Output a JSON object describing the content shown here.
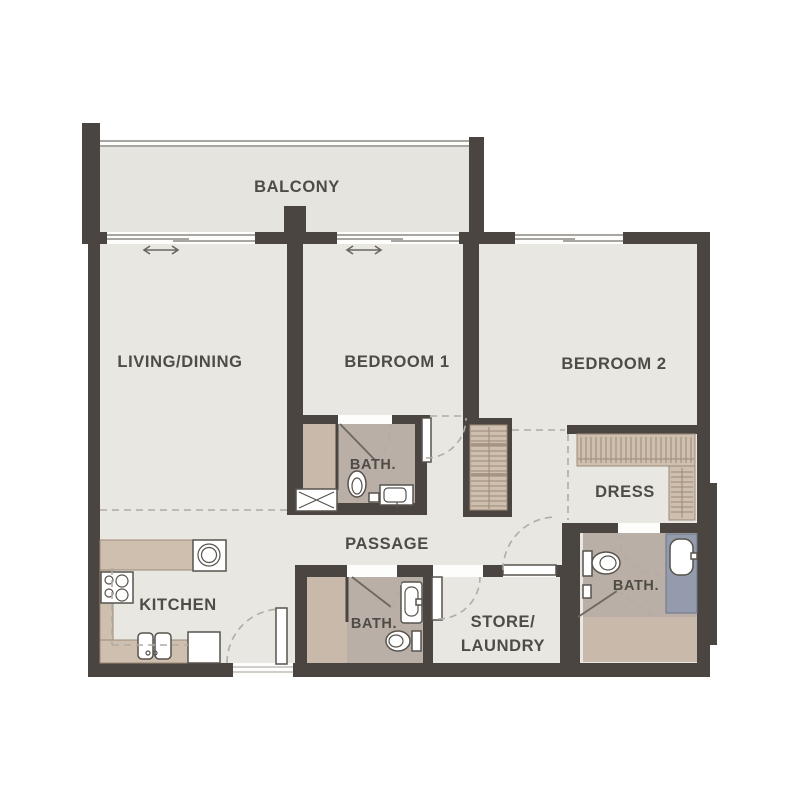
{
  "plan": {
    "type": "2-bedroom apartment floor plan",
    "rooms": {
      "balcony": {
        "label": "BALCONY"
      },
      "living_dining": {
        "label": "LIVING/DINING"
      },
      "bedroom_1": {
        "label": "BEDROOM 1"
      },
      "bedroom_2": {
        "label": "BEDROOM 2"
      },
      "bath_1": {
        "label": "BATH."
      },
      "passage": {
        "label": "PASSAGE"
      },
      "dress": {
        "label": "DRESS"
      },
      "kitchen": {
        "label": "KITCHEN"
      },
      "bath_2": {
        "label": "BATH."
      },
      "store_laundry": {
        "line1": "STORE/",
        "line2": "LAUNDRY"
      },
      "bath_3": {
        "label": "BATH."
      }
    },
    "colors": {
      "wall": "#4a4540",
      "floor": "#e9e7e2",
      "balcony_floor": "#e6e4df",
      "bath_floor": "#b9afa7",
      "wet_floor": "#c9b9ab",
      "cabinet": "#cfbfaf",
      "cabinet_line": "#9b8a79",
      "vanity": "#939bad",
      "outline": "#57534d",
      "dash": "#b2aca5",
      "window_line": "#8d8983",
      "label": "#4f4b46",
      "background": "#ffffff"
    },
    "fixtures": [
      "cooktop-4-burner",
      "washing-machine",
      "double-bowl-sink",
      "dishwasher",
      "kitchen-counter",
      "wardrobe",
      "shower-tray",
      "toilet",
      "wash-basin",
      "vanity-counter",
      "shower-screen",
      "door-swing",
      "sliding-door-arrow"
    ]
  }
}
